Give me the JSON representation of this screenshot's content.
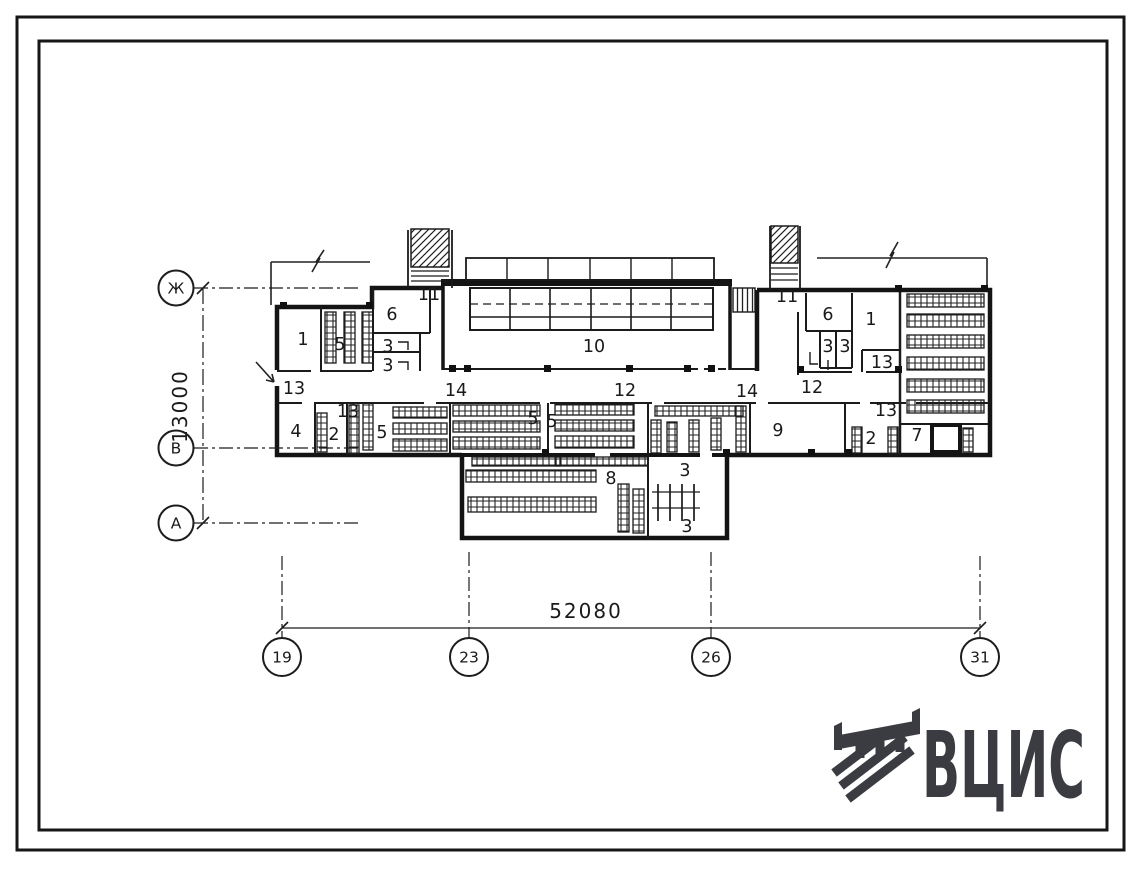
{
  "meta": {
    "kind": "scanned architectural floor plan sheet",
    "palette": {
      "paper": "#ffffff",
      "ink": "#1c1c1c",
      "logo": "#3b3b42"
    }
  },
  "logo": {
    "text": "ВЦИС",
    "icon_name": "hatched-sh-emblem-icon",
    "color": "#3b3b42"
  },
  "dimensions": {
    "vertical": "13000",
    "horizontal": "52080"
  },
  "axes": {
    "left": [
      {
        "label": "Ж",
        "cx": 176,
        "cy": 288
      },
      {
        "label": "В",
        "cx": 176,
        "cy": 448
      },
      {
        "label": "А",
        "cx": 176,
        "cy": 523
      }
    ],
    "bottom": [
      {
        "label": "19",
        "cx": 282,
        "cy": 657
      },
      {
        "label": "23",
        "cx": 469,
        "cy": 657
      },
      {
        "label": "26",
        "cx": 711,
        "cy": 657
      },
      {
        "label": "31",
        "cx": 980,
        "cy": 657
      }
    ]
  },
  "plan": {
    "room_labels": [
      {
        "text": "1",
        "x": 303,
        "y": 345
      },
      {
        "text": "5",
        "x": 340,
        "y": 350
      },
      {
        "text": "6",
        "x": 392,
        "y": 320
      },
      {
        "text": "3",
        "x": 388,
        "y": 352
      },
      {
        "text": "3",
        "x": 388,
        "y": 371
      },
      {
        "text": "11",
        "x": 429,
        "y": 300
      },
      {
        "text": "13",
        "x": 294,
        "y": 394
      },
      {
        "text": "4",
        "x": 296,
        "y": 437
      },
      {
        "text": "2",
        "x": 334,
        "y": 440
      },
      {
        "text": "13",
        "x": 348,
        "y": 417
      },
      {
        "text": "5",
        "x": 382,
        "y": 438
      },
      {
        "text": "14",
        "x": 456,
        "y": 396
      },
      {
        "text": "5",
        "x": 533,
        "y": 424
      },
      {
        "text": "5",
        "x": 552,
        "y": 427
      },
      {
        "text": "12",
        "x": 625,
        "y": 396
      },
      {
        "text": "10",
        "x": 594,
        "y": 352
      },
      {
        "text": "14",
        "x": 747,
        "y": 397
      },
      {
        "text": "11",
        "x": 787,
        "y": 302
      },
      {
        "text": "6",
        "x": 828,
        "y": 320
      },
      {
        "text": "3",
        "x": 828,
        "y": 352
      },
      {
        "text": "3",
        "x": 845,
        "y": 352
      },
      {
        "text": "1",
        "x": 871,
        "y": 325
      },
      {
        "text": "13",
        "x": 882,
        "y": 368
      },
      {
        "text": "12",
        "x": 812,
        "y": 393
      },
      {
        "text": "9",
        "x": 778,
        "y": 436
      },
      {
        "text": "13",
        "x": 886,
        "y": 416
      },
      {
        "text": "2",
        "x": 871,
        "y": 444
      },
      {
        "text": "7",
        "x": 917,
        "y": 441
      },
      {
        "text": "8",
        "x": 611,
        "y": 484
      },
      {
        "text": "3",
        "x": 685,
        "y": 476
      },
      {
        "text": "3",
        "x": 687,
        "y": 532
      }
    ]
  }
}
